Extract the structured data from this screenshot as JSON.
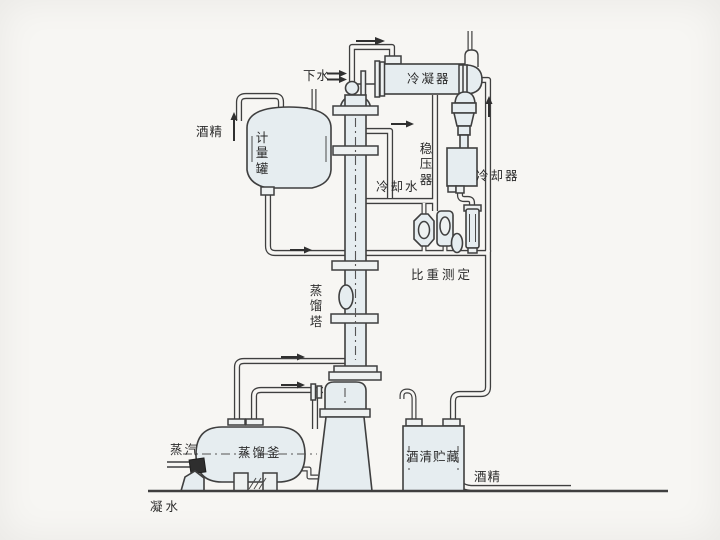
{
  "diagram": {
    "type": "process-flow-diagram",
    "subject": "alcohol distillation plant",
    "labels": {
      "drain_water": "下水",
      "condenser": "冷凝器",
      "alcohol_feed": "酒精",
      "measuring_tank": "计量罐",
      "pressure_stabilizer": "稳压器",
      "cooling_water": "冷却水",
      "cooler": "冷却器",
      "gravity_measurement": "比重测定",
      "distillation_tower": "蒸馏塔",
      "steam": "蒸汽",
      "distillation_kettle": "蒸馏釜",
      "alcohol_storage": "酒清贮藏",
      "alcohol_out": "酒精",
      "condensate": "凝水"
    },
    "colors": {
      "line": "#3f3f3f",
      "vessel_fill": "#e6edf0",
      "background": "#f7f6f3",
      "valve_fill": "#2e2e2e"
    }
  }
}
